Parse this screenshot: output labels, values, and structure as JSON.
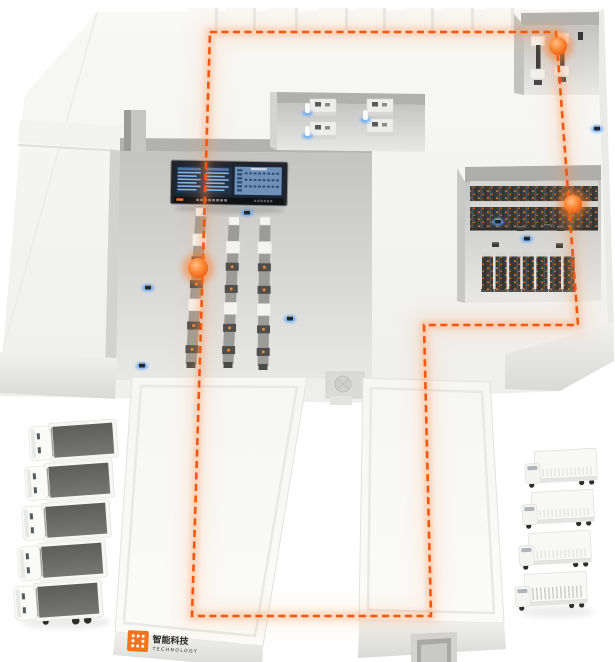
{
  "meta": {
    "description": "Isometric smart-warehouse facility illustration with orange AGV route loop, control display board, conveyor lines, storage racks, workstations, loading halls and truck fleets"
  },
  "colors": {
    "background": "#FFFFFF",
    "building_top": "#F5F5F3",
    "building_front": "#E3E3E1",
    "recess_floor_dark": "#C3C3C1",
    "recess_floor_light": "#E6E6E4",
    "recess_wall": "#B2B2B0",
    "rack_dark": "#3B3B39",
    "rack_cap": "#D6D6D4",
    "route_orange": "#F2570F",
    "glow_orange": "#FF8A3C",
    "marker_orange": "#F97C1F",
    "sensor_blue": "#55A6FF",
    "screen_navy": "#1B2533",
    "screen_panel_blue": "#6F91BA",
    "screen_text_blue": "#86B4E4",
    "truck_bed_gray": "#6B6B69",
    "logo_orange": "#F4731E"
  },
  "logo": {
    "brand_cn": "智能科技",
    "brand_en": "TECHNOLOGY"
  },
  "route": {
    "style": "dashed",
    "closed": true,
    "points": [
      [
        210,
        32
      ],
      [
        556,
        32
      ],
      [
        578,
        325
      ],
      [
        424,
        325
      ],
      [
        431,
        616
      ],
      [
        192,
        616
      ]
    ]
  },
  "markers": [
    [
      558,
      46,
      9
    ],
    [
      573,
      204,
      9
    ],
    [
      198,
      268,
      10
    ]
  ],
  "sensors": [
    [
      148,
      287
    ],
    [
      247,
      212
    ],
    [
      290,
      318
    ],
    [
      142,
      365
    ],
    [
      597,
      128
    ],
    [
      498,
      221
    ],
    [
      527,
      238
    ]
  ],
  "conveyors": [
    {
      "x1": 201,
      "y1": 216,
      "x2": 191,
      "y2": 364
    },
    {
      "x1": 234,
      "y1": 225,
      "x2": 228,
      "y2": 364
    },
    {
      "x1": 265,
      "y1": 225,
      "x2": 263,
      "y2": 366
    }
  ],
  "workstations": [
    [
      310,
      99
    ],
    [
      310,
      122
    ],
    [
      367,
      99
    ],
    [
      367,
      119
    ]
  ],
  "operators": [
    [
      305,
      103
    ],
    [
      305,
      126
    ],
    [
      363,
      110
    ]
  ],
  "rack_bank_rows": [
    181,
    202
  ],
  "rack_units": {
    "x0": 482,
    "step": 13.6,
    "count": 7,
    "y": 252
  },
  "rack_devices": [
    [
      517,
      226
    ],
    [
      544,
      224
    ],
    [
      557,
      226
    ],
    [
      492,
      242
    ],
    [
      556,
      243
    ]
  ],
  "machines": [
    [
      531,
      36
    ],
    [
      555,
      33
    ]
  ],
  "roof_blocks": [
    188,
    226,
    268,
    318,
    356,
    404,
    444,
    484
  ],
  "trucks_left": {
    "count": 5,
    "positions": [
      [
        28,
        424
      ],
      [
        24,
        464
      ],
      [
        21,
        504
      ],
      [
        17,
        544
      ],
      [
        13,
        584
      ]
    ]
  },
  "trucks_right": {
    "count": 4,
    "positions": [
      [
        524,
        452
      ],
      [
        521,
        493
      ],
      [
        518,
        534
      ],
      [
        514,
        575
      ]
    ]
  },
  "board": {
    "left_table_columns": 2,
    "left_table_rows": 6,
    "right_grid_rows": 3,
    "right_grid_cols": 8
  }
}
